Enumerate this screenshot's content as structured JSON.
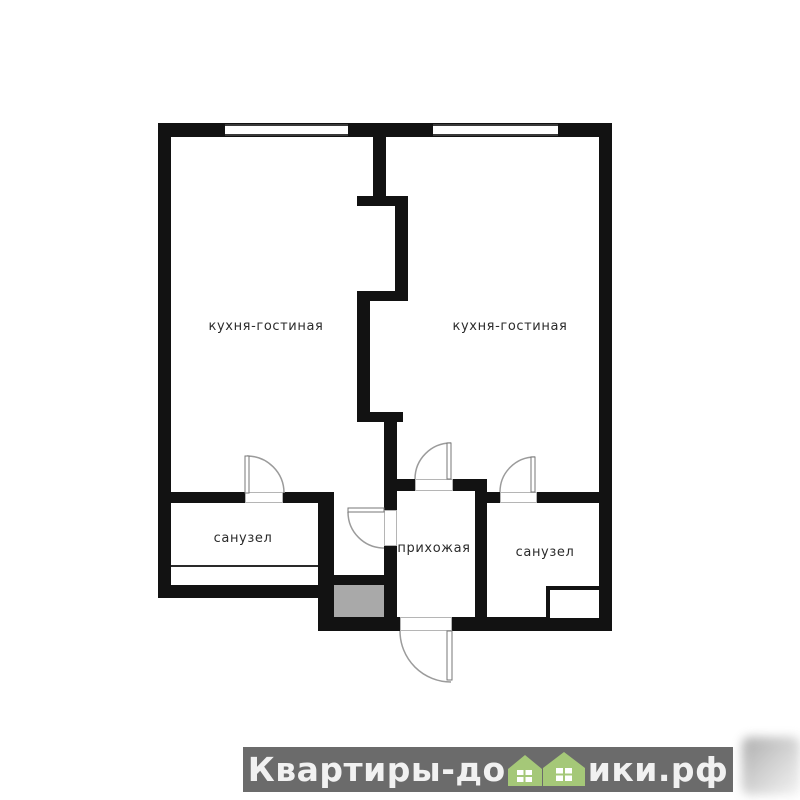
{
  "plan": {
    "rooms": [
      {
        "id": "kitchen-living-left",
        "label": "кухня-гостиная"
      },
      {
        "id": "kitchen-living-right",
        "label": "кухня-гостиная"
      },
      {
        "id": "bathroom-left",
        "label": "санузел"
      },
      {
        "id": "hallway",
        "label": "прихожая"
      },
      {
        "id": "bathroom-right",
        "label": "санузел"
      }
    ],
    "features": {
      "windows_count": 2,
      "doors_count": 5,
      "shaft": "ventilation-shaft",
      "colors": {
        "wall": "#121212",
        "shaft_fill": "#a9a9a9",
        "door_arc": "#9b9b9b"
      }
    }
  },
  "watermark": {
    "prefix": "Квартиры-до",
    "suffix": "ики.рф",
    "full_text": "Квартиры-домики.рф",
    "icon": "green-houses-icon",
    "colors": {
      "bar": "#6b6b6b",
      "text": "#f1f1f1",
      "house_green": "#a5c878"
    }
  }
}
